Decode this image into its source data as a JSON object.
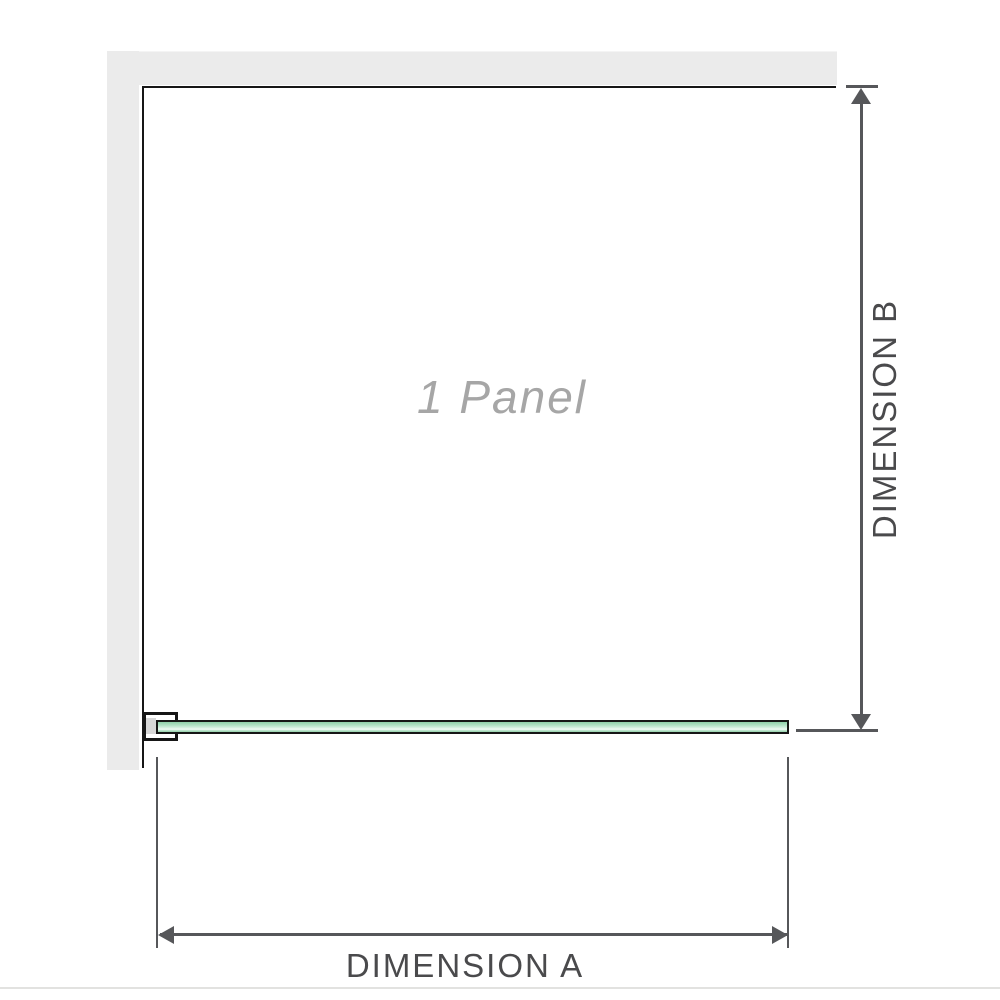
{
  "diagram": {
    "panel_label": "1 Panel",
    "dimension_a_label": "DIMENSION A",
    "dimension_b_label": "DIMENSION B"
  },
  "colors": {
    "wall": "#ebebeb",
    "wall-edge": "#f4f4f4",
    "outline": "#161616",
    "dimension": "#56575a",
    "dim-label": "#4a4a4c",
    "panel-text": "#a6a6a6",
    "bracket-shade": "#d7d7d7",
    "glass-top": "#8ecfa8",
    "glass-mid": "#b9e4ca",
    "glass-light": "#ddf2e6",
    "glass-stripe": "#f3fbf7",
    "glass-bottom": "#95d0ab",
    "rule": "#e2e2e0"
  }
}
